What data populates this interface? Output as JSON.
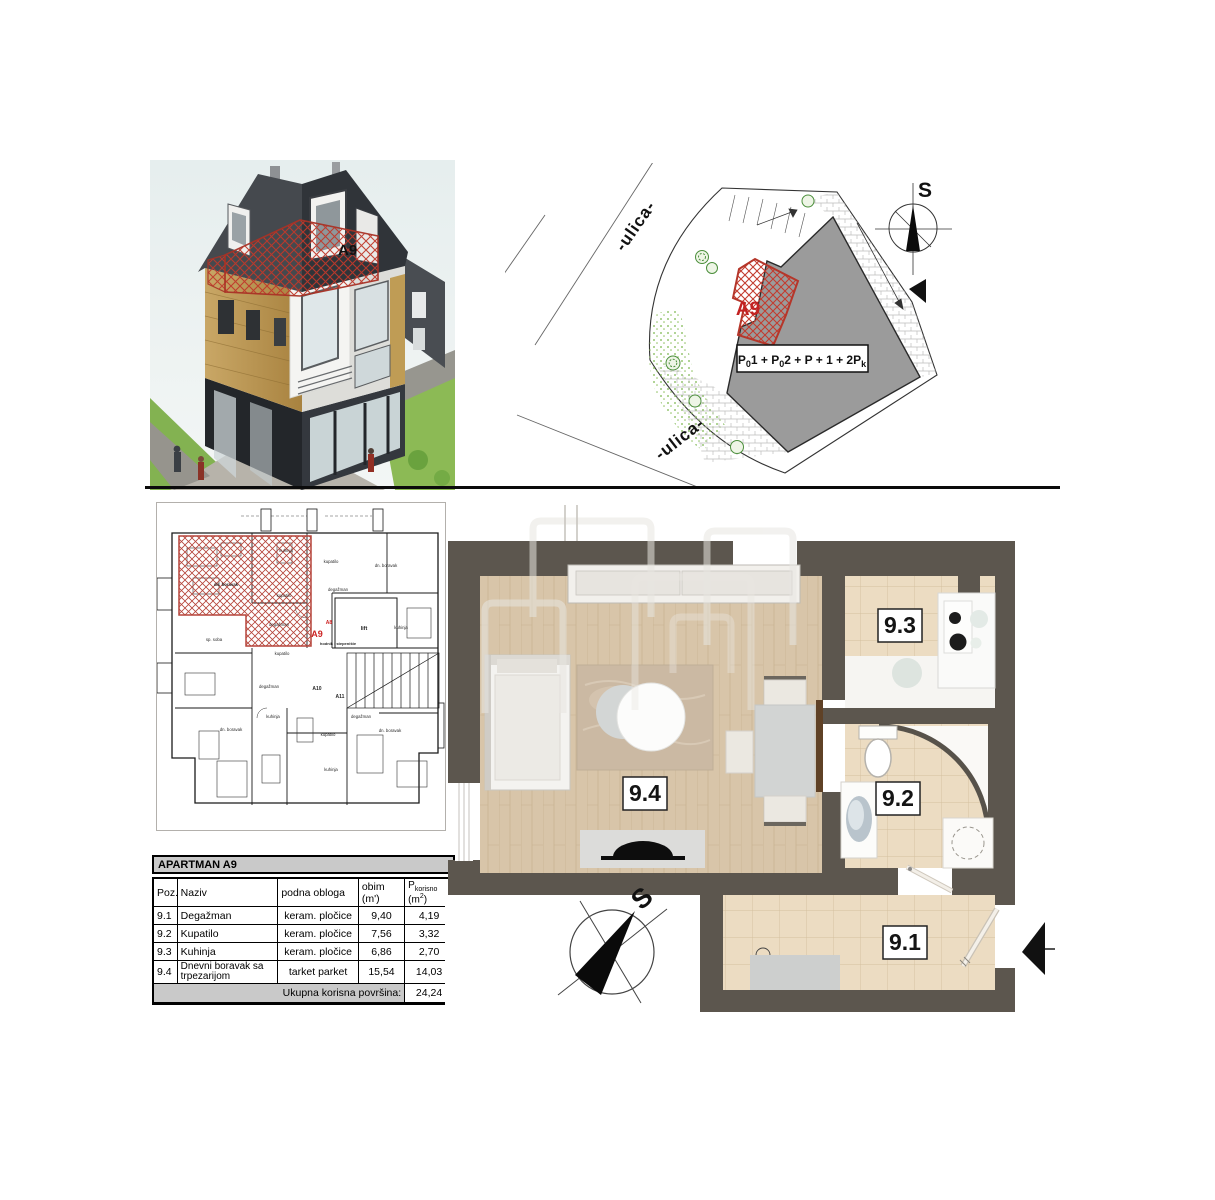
{
  "colors": {
    "wall": "#5c564e",
    "wood_floor": "#d8c5a9",
    "tile_floor": "#ecdcc2",
    "hatch_red": "#c0392b",
    "building_gray": "#9b9b9b",
    "table_band_gray": "#c9c9c9",
    "accent_red": "#cc2222"
  },
  "render_3d": {
    "apartment_label": "A9"
  },
  "site_plan": {
    "street_label_top": "-ulica-",
    "street_label_bottom": "-ulica-",
    "compass_label": "S",
    "apartment_label": "A9",
    "formula": {
      "seg1": "P",
      "sub1": "0",
      "seg2": "1 + P",
      "sub2": "0",
      "seg3": "2 + P + 1 + 2P",
      "sub3": "k"
    }
  },
  "overview_plan": {
    "apartment_label": "A9",
    "labels": {
      "kuhinja_top": "kuhinja",
      "kupatilo_top": "kupatilo",
      "dn_boravak_top_right": "dn. boravak",
      "dn_boravak_hatch": "dn. boravak",
      "kupatilo_hatch": "kupatilo",
      "degazman_top": "degažman",
      "degazman_hatch": "degažman",
      "sp_soba": "sp. soba",
      "a8": "A8",
      "lift": "lift",
      "kuhinja_right": "kuhinja",
      "hodnik": "hodnik i stepenište",
      "kupatilo_mid": "kupatilo",
      "degazman_mid": "degažman",
      "a10": "A10",
      "a11": "A11",
      "kuhinja_mid": "kuhinja",
      "dn_boravak_bottom_left": "dn. boravak",
      "kupatilo_bottom": "kupatilo",
      "degazman_right": "degažman",
      "dn_boravak_bottom_right": "dn. boravak",
      "kuhinja_bottom": "kuhinja"
    }
  },
  "main_plan": {
    "compass_label": "S",
    "room_labels": {
      "r91": "9.1",
      "r92": "9.2",
      "r93": "9.3",
      "r94": "9.4"
    }
  },
  "table": {
    "title": "APARTMAN A9",
    "headers": {
      "poz": "Poz.",
      "naziv": "Naziv",
      "obloga": "podna obloga",
      "obim": "obim (m')",
      "p_main": "P",
      "p_sub": "korisno",
      "p_unit_pre": " (m",
      "p_sup": "2",
      "p_close": ")"
    },
    "rows": [
      {
        "poz": "9.1",
        "naziv": "Degažman",
        "obloga": "keram. pločice",
        "obim": "9,40",
        "p": "4,19"
      },
      {
        "poz": "9.2",
        "naziv": "Kupatilo",
        "obloga": "keram. pločice",
        "obim": "7,56",
        "p": "3,32"
      },
      {
        "poz": "9.3",
        "naziv": "Kuhinja",
        "obloga": "keram. pločice",
        "obim": "6,86",
        "p": "2,70"
      },
      {
        "poz": "9.4",
        "naziv": "Dnevni boravak sa trpezarijom",
        "obloga": "tarket parket",
        "obim": "15,54",
        "p": "14,03"
      }
    ],
    "footer": {
      "label": "Ukupna korisna površina:",
      "value": "24,24"
    }
  }
}
